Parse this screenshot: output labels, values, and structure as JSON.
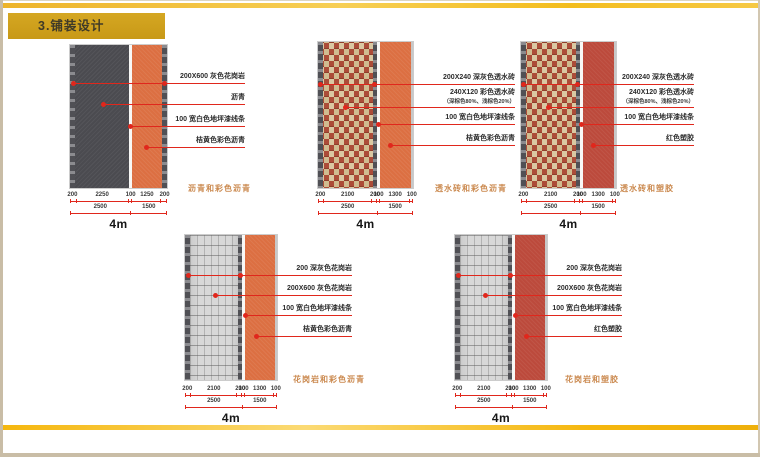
{
  "page": {
    "title": "3.铺装设计"
  },
  "colors": {
    "gold_bar": "#cda01e",
    "gold_accent_line": "#f2b70a",
    "leader_red": "#e0271c",
    "caption_orange": "#cb8a50",
    "asphalt_gray": "#4b4b50",
    "colored_asphalt_orange": "#dc6f42",
    "rubber_red": "#bc4a3c",
    "brick_red": "#ac4c38",
    "granite_light": "#d8d8d8",
    "granite_dark_edge": "#5a5a5f"
  },
  "diagrams": [
    {
      "caption": "沥青和彩色沥青",
      "labels": [
        "200X600 灰色花岗岩",
        "沥青",
        "100 宽白色地坪漆线条",
        "桔黄色彩色沥青"
      ],
      "sublabels": [
        "",
        "",
        "",
        ""
      ],
      "dims_row1": [
        "200",
        "2250",
        "100",
        "1250",
        "200"
      ],
      "dims_row2": [
        "2500",
        "1500"
      ],
      "total_width": "4m"
    },
    {
      "caption": "透水砖和彩色沥青",
      "labels": [
        "200X240 深灰色透水砖",
        "240X120 彩色透水砖",
        "100 宽白色地坪漆线条",
        "桔黄色彩色沥青"
      ],
      "sublabels": [
        "",
        "（深棕色80%、浅棕色20%）",
        "",
        ""
      ],
      "dims_row1": [
        "200",
        "2100",
        "200",
        "100",
        "1300",
        "100"
      ],
      "dims_row2": [
        "2500",
        "1500"
      ],
      "total_width": "4m"
    },
    {
      "caption": "透水砖和塑胶",
      "labels": [
        "200X240 深灰色透水砖",
        "240X120 彩色透水砖",
        "100 宽白色地坪漆线条",
        "红色塑胶"
      ],
      "sublabels": [
        "",
        "（深棕色80%、浅棕色20%）",
        "",
        ""
      ],
      "dims_row1": [
        "200",
        "2100",
        "200",
        "100",
        "1300",
        "100"
      ],
      "dims_row2": [
        "2500",
        "1500"
      ],
      "total_width": "4m"
    },
    {
      "caption": "花岗岩和彩色沥青",
      "labels": [
        "200 深灰色花岗岩",
        "200X600 灰色花岗岩",
        "100 宽白色地坪漆线条",
        "桔黄色彩色沥青"
      ],
      "sublabels": [
        "",
        "",
        "",
        ""
      ],
      "dims_row1": [
        "200",
        "2100",
        "200",
        "100",
        "1300",
        "100"
      ],
      "dims_row2": [
        "2500",
        "1500"
      ],
      "total_width": "4m"
    },
    {
      "caption": "花岗岩和塑胶",
      "labels": [
        "200 深灰色花岗岩",
        "200X600 灰色花岗岩",
        "100 宽白色地坪漆线条",
        "红色塑胶"
      ],
      "sublabels": [
        "",
        "",
        "",
        ""
      ],
      "dims_row1": [
        "200",
        "2100",
        "200",
        "100",
        "1300",
        "100"
      ],
      "dims_row2": [
        "2500",
        "1500"
      ],
      "total_width": "4m"
    }
  ]
}
